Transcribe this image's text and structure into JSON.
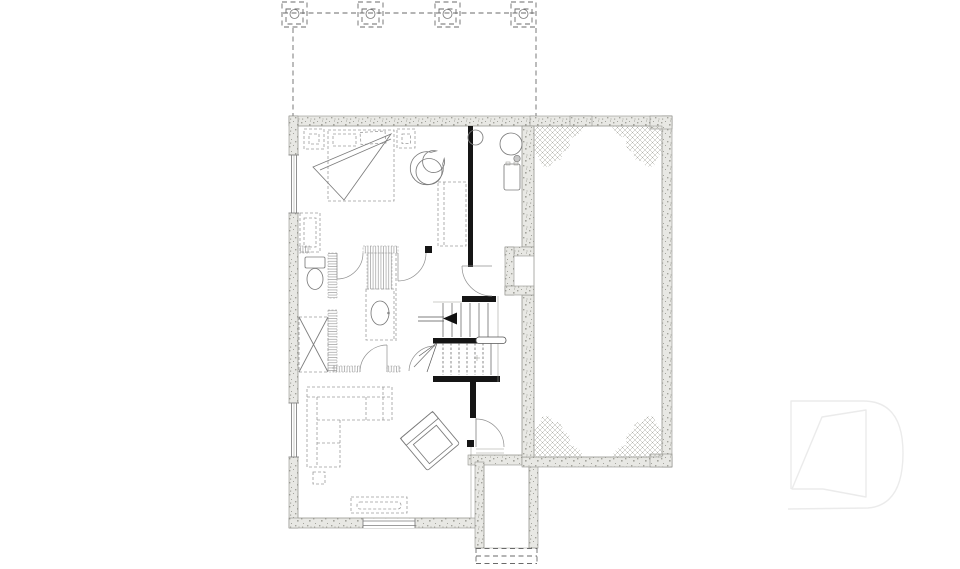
{
  "page": {
    "kind": "architectural floor plan drawing",
    "floor": "basement"
  },
  "colors": {
    "background": "#ffffff",
    "line": "#555555",
    "thin_line": "#9a9a94",
    "wall_fill": "#e8e8e4",
    "wall_speckle": "#a3a39c",
    "wall_outline": "#8b8b85",
    "new_wall": "#151515",
    "furniture_dash": "#9c9c9c",
    "furniture_solid": "#7c7c7c",
    "hatch": "#8f8f8f",
    "crosshatch": "#b0b0aa",
    "door_arc": "#8f8f8f",
    "watermark": "#ebebeb"
  },
  "watermark": {
    "name": "door-letter-d-logo",
    "letter": "D"
  },
  "plan": {
    "type": "floor-plan",
    "areas": [
      {
        "name": "deck-above",
        "features": [
          "dashed-outline",
          "four-footing-posts-with-piers"
        ]
      },
      {
        "name": "bedroom",
        "furniture": [
          "bed-with-pillows-and-folded-blanket",
          "nightstand-left",
          "nightstand-right",
          "tub-chair",
          "round-side-table",
          "dresser",
          "wardrobe"
        ]
      },
      {
        "name": "bathroom",
        "fixtures": [
          "toilet",
          "shower-box-x",
          "linen-cabinet",
          "vanity-with-oval-sink"
        ],
        "walls": [
          "hatched-partitions",
          "door-swing-arcs"
        ]
      },
      {
        "name": "stair-hall",
        "features": [
          "u-shaped-winder-stairs",
          "up-direction-arrow",
          "handrail",
          "dashed-lower-treads",
          "new-black-walls"
        ]
      },
      {
        "name": "utility-room",
        "fixtures": [
          "tank-small",
          "tank-large",
          "valve-circle",
          "equipment-panel"
        ]
      },
      {
        "name": "living-room",
        "furniture": [
          "l-sectional-sofa",
          "side-table",
          "rotated-armchair",
          "tv-console"
        ]
      },
      {
        "name": "rear-hall",
        "features": [
          "exterior-door",
          "threshold"
        ]
      },
      {
        "name": "exterior-stairwell",
        "features": [
          "concrete-walls",
          "dashed-steps-up"
        ]
      },
      {
        "name": "garage",
        "features": [
          "stippled-foundation-walls",
          "wall-pilasters",
          "chimney-notch",
          "crosshatched-corner-patches"
        ]
      }
    ],
    "windows": [
      "left-wall-upper",
      "left-wall-lower",
      "bottom-wall"
    ]
  }
}
